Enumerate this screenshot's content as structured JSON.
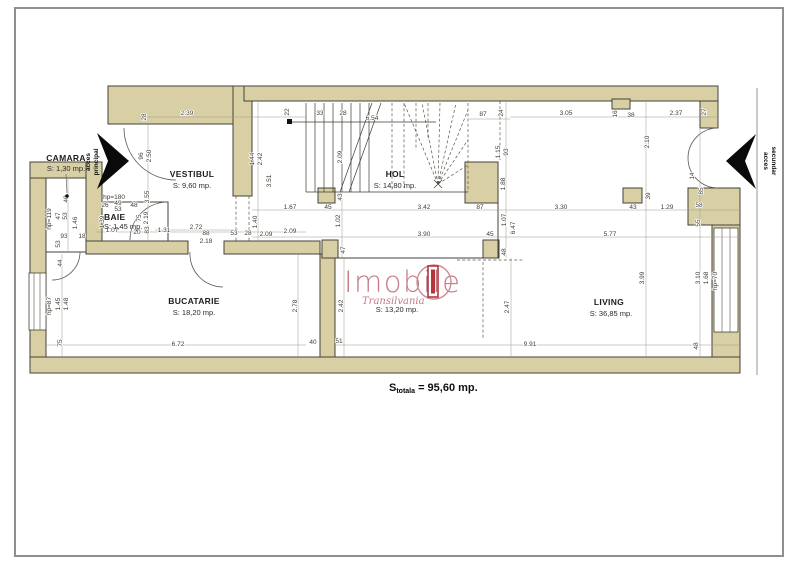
{
  "page": {
    "background": "#ffffff",
    "frame_color": "#8f8f8f"
  },
  "plan": {
    "wall_color": "#d8d0a4",
    "outline_color": "#45423a",
    "rooms": [
      {
        "id": "camara",
        "name": "CAMARA",
        "area": "S: 1,30 mp."
      },
      {
        "id": "vestibul",
        "name": "VESTIBUL",
        "area": "S: 9,60 mp."
      },
      {
        "id": "baie",
        "name": "BAIE",
        "area": "S: 1,45 mp."
      },
      {
        "id": "hol",
        "name": "HOL",
        "area": "S: 14,80 mp."
      },
      {
        "id": "bucatarie",
        "name": "BUCATARIE",
        "area": "S: 18,20 mp."
      },
      {
        "id": "dining",
        "name": "",
        "area": "S: 13,20 mp."
      },
      {
        "id": "living",
        "name": "LIVING",
        "area": "S: 36,85 mp."
      }
    ],
    "entrances": [
      {
        "id": "principal",
        "line1": "acces",
        "line2": "principal"
      },
      {
        "id": "secundar",
        "line1": "acces",
        "line2": "secundar"
      }
    ],
    "total": {
      "prefix": "S",
      "subscript": "totala",
      "value": " = 95,60 mp."
    },
    "dimensions": [
      {
        "t": "28",
        "x": 146,
        "y": 117,
        "r": 1
      },
      {
        "t": "2.39",
        "x": 187,
        "y": 115
      },
      {
        "t": "22",
        "x": 289,
        "y": 112,
        "r": 1
      },
      {
        "t": "33",
        "x": 320,
        "y": 115
      },
      {
        "t": "28",
        "x": 343,
        "y": 115
      },
      {
        "t": "6.54",
        "x": 372,
        "y": 120
      },
      {
        "t": "87",
        "x": 483,
        "y": 116
      },
      {
        "t": "24",
        "x": 503,
        "y": 113,
        "r": 1
      },
      {
        "t": "3.05",
        "x": 566,
        "y": 115
      },
      {
        "t": "16",
        "x": 617,
        "y": 114,
        "r": 1
      },
      {
        "t": "38",
        "x": 631,
        "y": 117
      },
      {
        "t": "2.37",
        "x": 676,
        "y": 115
      },
      {
        "t": "27",
        "x": 706,
        "y": 112,
        "r": 1
      },
      {
        "t": "96",
        "x": 143,
        "y": 156,
        "r": 1
      },
      {
        "t": "2.50",
        "x": 151,
        "y": 156,
        "r": 1
      },
      {
        "t": "3.55",
        "x": 149,
        "y": 197,
        "r": 1
      },
      {
        "t": "83",
        "x": 149,
        "y": 230,
        "r": 1
      },
      {
        "t": "1.44",
        "x": 254,
        "y": 159,
        "r": 1
      },
      {
        "t": "2.42",
        "x": 262,
        "y": 159,
        "r": 1
      },
      {
        "t": "3.51",
        "x": 271,
        "y": 181,
        "r": 1
      },
      {
        "t": "1.40",
        "x": 257,
        "y": 222,
        "r": 1
      },
      {
        "t": "2.09",
        "x": 342,
        "y": 157,
        "r": 1
      },
      {
        "t": "43",
        "x": 342,
        "y": 197,
        "r": 1
      },
      {
        "t": "1.02",
        "x": 340,
        "y": 221,
        "r": 1
      },
      {
        "t": "1.15",
        "x": 500,
        "y": 152,
        "r": 1
      },
      {
        "t": "93",
        "x": 508,
        "y": 152,
        "r": 1
      },
      {
        "t": "1.88",
        "x": 505,
        "y": 184,
        "r": 1
      },
      {
        "t": "1.07",
        "x": 506,
        "y": 220,
        "r": 1
      },
      {
        "t": "6.47",
        "x": 515,
        "y": 228,
        "r": 1
      },
      {
        "t": "1.67",
        "x": 290,
        "y": 209
      },
      {
        "t": "45",
        "x": 328,
        "y": 209
      },
      {
        "t": "3.42",
        "x": 424,
        "y": 209
      },
      {
        "t": "87",
        "x": 480,
        "y": 209
      },
      {
        "t": "3.30",
        "x": 561,
        "y": 209
      },
      {
        "t": "43",
        "x": 633,
        "y": 209
      },
      {
        "t": "1.29",
        "x": 667,
        "y": 209
      },
      {
        "t": "58",
        "x": 699,
        "y": 207
      },
      {
        "t": "55",
        "x": 700,
        "y": 223,
        "r": 1
      },
      {
        "t": "2.09",
        "x": 266,
        "y": 236
      },
      {
        "t": "3.90",
        "x": 424,
        "y": 236
      },
      {
        "t": "45",
        "x": 490,
        "y": 236
      },
      {
        "t": "5.77",
        "x": 610,
        "y": 236
      },
      {
        "t": "2.10",
        "x": 649,
        "y": 142,
        "r": 1
      },
      {
        "t": "39",
        "x": 650,
        "y": 196,
        "r": 1
      },
      {
        "t": "3.99",
        "x": 644,
        "y": 278,
        "r": 1
      },
      {
        "t": "14",
        "x": 694,
        "y": 176,
        "r": 1
      },
      {
        "t": "85",
        "x": 703,
        "y": 191,
        "r": 1
      },
      {
        "t": "3.10",
        "x": 700,
        "y": 278,
        "r": 1
      },
      {
        "t": "1.68",
        "x": 708,
        "y": 278,
        "r": 1
      },
      {
        "t": "hp=70",
        "x": 717,
        "y": 281,
        "r": 1
      },
      {
        "t": "48",
        "x": 698,
        "y": 346,
        "r": 1
      },
      {
        "t": "6.72",
        "x": 178,
        "y": 346
      },
      {
        "t": "40",
        "x": 313,
        "y": 344
      },
      {
        "t": "51",
        "x": 339,
        "y": 343
      },
      {
        "t": "9.91",
        "x": 530,
        "y": 346
      },
      {
        "t": "2.78",
        "x": 297,
        "y": 306,
        "r": 1
      },
      {
        "t": "2.47",
        "x": 509,
        "y": 307,
        "r": 1
      },
      {
        "t": "2.42",
        "x": 343,
        "y": 306,
        "r": 1
      },
      {
        "t": "47",
        "x": 345,
        "y": 250,
        "r": 1
      },
      {
        "t": "48",
        "x": 506,
        "y": 252,
        "r": 1
      },
      {
        "t": "44",
        "x": 62,
        "y": 263,
        "r": 1
      },
      {
        "t": "1.45",
        "x": 60,
        "y": 304,
        "r": 1
      },
      {
        "t": "1.48",
        "x": 68,
        "y": 304,
        "r": 1
      },
      {
        "t": "75",
        "x": 62,
        "y": 343,
        "r": 1
      },
      {
        "t": "hp=87",
        "x": 51,
        "y": 306,
        "r": 1
      },
      {
        "t": "93",
        "x": 64,
        "y": 238
      },
      {
        "t": "18",
        "x": 82,
        "y": 238
      },
      {
        "t": "1.07",
        "x": 112,
        "y": 232
      },
      {
        "t": "20",
        "x": 137,
        "y": 234
      },
      {
        "t": "1.31",
        "x": 164,
        "y": 232
      },
      {
        "t": "2.72",
        "x": 196,
        "y": 229
      },
      {
        "t": "88",
        "x": 206,
        "y": 235
      },
      {
        "t": "2.18",
        "x": 206,
        "y": 243
      },
      {
        "t": "53",
        "x": 234,
        "y": 235
      },
      {
        "t": "28",
        "x": 248,
        "y": 235
      },
      {
        "t": "2.09",
        "x": 290,
        "y": 233
      },
      {
        "t": "40",
        "x": 68,
        "y": 199,
        "r": 1
      },
      {
        "t": "47",
        "x": 60,
        "y": 216,
        "r": 1
      },
      {
        "t": "53",
        "x": 67,
        "y": 216,
        "r": 1
      },
      {
        "t": "1.46",
        "x": 77,
        "y": 223,
        "r": 1
      },
      {
        "t": "53",
        "x": 60,
        "y": 244,
        "r": 1
      },
      {
        "t": "hp=119",
        "x": 51,
        "y": 219,
        "r": 1
      },
      {
        "t": "hp=180",
        "x": 114,
        "y": 199
      },
      {
        "t": "26",
        "x": 105,
        "y": 207
      },
      {
        "t": "49",
        "x": 118,
        "y": 205
      },
      {
        "t": "48",
        "x": 134,
        "y": 207
      },
      {
        "t": "53",
        "x": 118,
        "y": 211
      },
      {
        "t": "1.39",
        "x": 104,
        "y": 222,
        "r": 1
      },
      {
        "t": "75",
        "x": 141,
        "y": 218,
        "r": 1
      },
      {
        "t": "2.19",
        "x": 148,
        "y": 218,
        "r": 1
      }
    ]
  },
  "watermark": {
    "brand": "Imobile",
    "region": "Transilvania",
    "text_color": "#c47c85",
    "door_color": "#b5343c"
  }
}
